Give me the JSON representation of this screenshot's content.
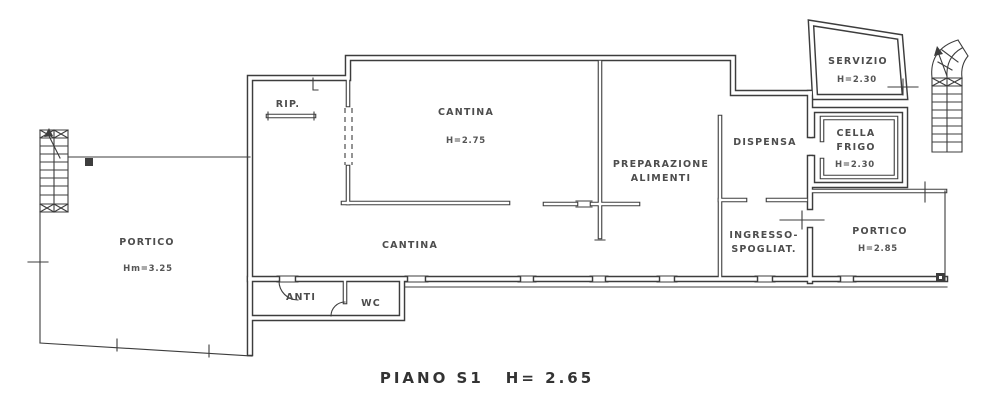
{
  "caption": {
    "floor": "PIANO S1",
    "height": "H= 2.65"
  },
  "rooms": {
    "portico_left": {
      "label": "PORTICO",
      "height": "Hm=3.25"
    },
    "rip": {
      "label": "RIP."
    },
    "cantina_upper": {
      "label": "CANTINA",
      "height": "H=2.75"
    },
    "preparazione": {
      "label": "PREPARAZIONE\nALIMENTI"
    },
    "dispensa": {
      "label": "DISPENSA"
    },
    "servizio": {
      "label": "SERVIZIO",
      "height": "H=2.30"
    },
    "cella_frigo": {
      "label": "CELLA\nFRIGO",
      "height": "H=2.30"
    },
    "ingresso": {
      "label": "INGRESSO-\nSPOGLIAT."
    },
    "portico_right": {
      "label": "PORTICO",
      "height": "H=2.85"
    },
    "cantina_lower": {
      "label": "CANTINA"
    },
    "anti": {
      "label": "ANTI"
    },
    "wc": {
      "label": "WC"
    }
  },
  "colors": {
    "line": "#3d3d3d",
    "text": "#4d4d4d",
    "background": "#ffffff"
  }
}
